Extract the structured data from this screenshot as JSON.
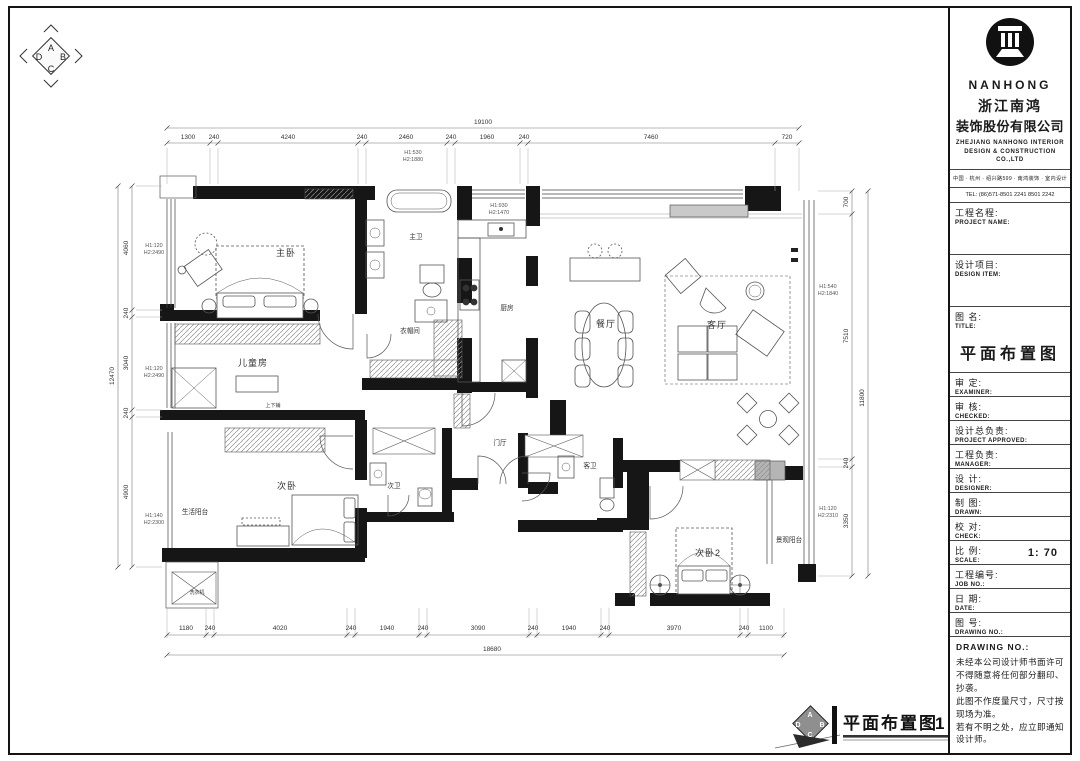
{
  "orientation": {
    "letters": [
      "A",
      "B",
      "C",
      "D"
    ]
  },
  "company": {
    "logo_text": "NANHONG",
    "name_cn_1": "浙江南鸿",
    "name_cn_2": "装饰股份有限公司",
    "name_en": "ZHEJIANG NANHONG INTERIOR DESIGN & CONSTRUCTION CO.,LTD",
    "address": "中国 · 杭州 · 绍兴路599 · 南鸿装饰 · 室内设计",
    "tel": "TEL: (86)571-8501 2241  8501 2242"
  },
  "title_block": {
    "rows": [
      {
        "cn": "工程名程:",
        "en": "PROJECT NAME:",
        "value": ""
      },
      {
        "cn": "设计项目:",
        "en": "DESIGN ITEM:",
        "value": ""
      },
      {
        "cn": "图  名:",
        "en": "TITLE:",
        "value": "平面布置图"
      },
      {
        "cn": "审  定:",
        "en": "EXAMINER:",
        "value": ""
      },
      {
        "cn": "审  核:",
        "en": "CHECKED:",
        "value": ""
      },
      {
        "cn": "设计总负责:",
        "en": "PROJECT APPROVED:",
        "value": ""
      },
      {
        "cn": "工程负责:",
        "en": "MANAGER:",
        "value": ""
      },
      {
        "cn": "设  计:",
        "en": "DESIGNER:",
        "value": ""
      },
      {
        "cn": "制  图:",
        "en": "DRAWN:",
        "value": ""
      },
      {
        "cn": "校  对:",
        "en": "CHECK:",
        "value": ""
      },
      {
        "cn": "比  例:",
        "en": "SCALE:",
        "value": "1: 70"
      },
      {
        "cn": "工程编号:",
        "en": "JOB NO.:",
        "value": ""
      },
      {
        "cn": "日  期:",
        "en": "DATE:",
        "value": ""
      },
      {
        "cn": "图  号:",
        "en": "DRAWING NO.:",
        "value": ""
      }
    ],
    "notes_header": "DRAWING NO.:",
    "notes": [
      "未经本公司设计师书面许可不得随意将任何部分翻印、抄袭。",
      "此图不作度量尺寸，尺寸按现场为准。",
      "若有不明之处，应立即通知设计师。"
    ]
  },
  "plan": {
    "rooms": [
      "主卧",
      "主卫",
      "衣帽间",
      "厨房",
      "餐厅",
      "客厅",
      "儿童房",
      "上下铺",
      "次卧",
      "次卫",
      "生活阳台",
      "洗衣机",
      "门厅",
      "客卫",
      "次卧2",
      "景观阳台"
    ],
    "annotations": [
      {
        "l1": "H1:530",
        "l2": "H2:1880"
      },
      {
        "l1": "H1:930",
        "l2": "H2:1470"
      },
      {
        "l1": "H1:120",
        "l2": "H2:2490"
      },
      {
        "l1": "H1:120",
        "l2": "H2:2490"
      },
      {
        "l1": "H1:140",
        "l2": "H2:2300"
      },
      {
        "l1": "H1:540",
        "l2": "H2:1840"
      },
      {
        "l1": "H1:120",
        "l2": "H2:2310"
      }
    ],
    "dims": {
      "top": {
        "total": "19100",
        "segs": [
          "1300",
          "240",
          "4240",
          "240",
          "2460",
          "240",
          "1960",
          "240",
          "7460",
          "720"
        ]
      },
      "bottom": {
        "total": "18680",
        "segs": [
          "1180",
          "240",
          "4020",
          "240",
          "1940",
          "240",
          "3090",
          "240",
          "1940",
          "240",
          "3970",
          "240",
          "1100"
        ]
      },
      "left": {
        "total": "12470",
        "segs": [
          "4060",
          "240",
          "3040",
          "240",
          "4900"
        ]
      },
      "right": {
        "total": "11800",
        "segs": [
          "700",
          "7510",
          "240",
          "3350"
        ]
      }
    }
  },
  "footer": {
    "title": "平面布置图",
    "scale": "1 : 70"
  }
}
